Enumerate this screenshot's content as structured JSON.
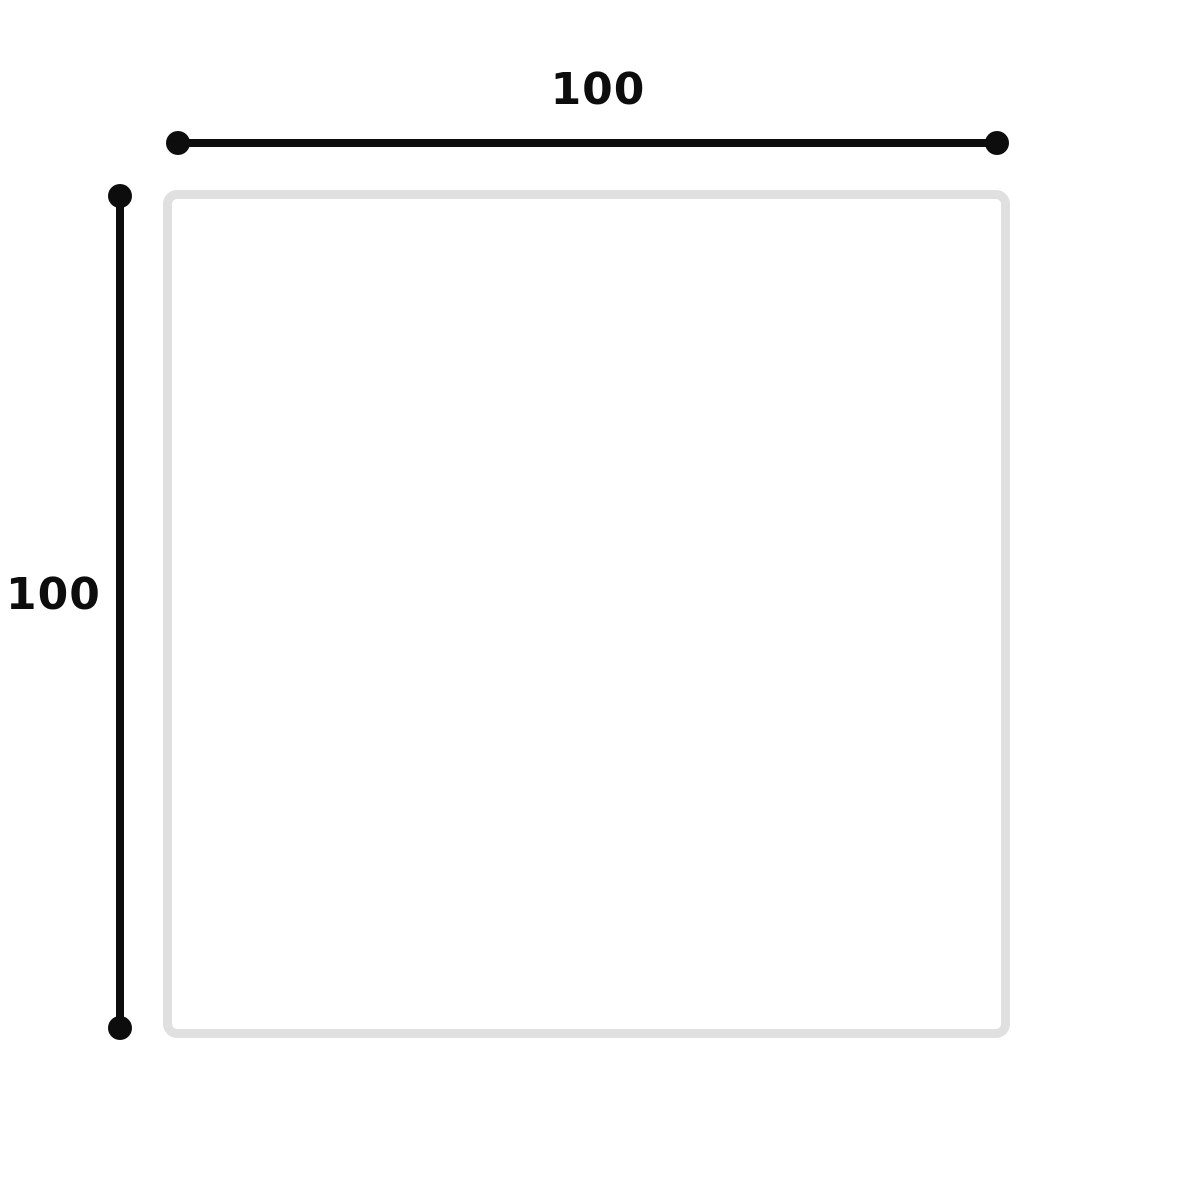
{
  "diagram": {
    "name": "dimensioned-square",
    "shape": {
      "type": "square",
      "fill": "#ffffff",
      "border_color": "#e0e0e0"
    },
    "dimensions": {
      "width": {
        "label": "100"
      },
      "height": {
        "label": "100"
      }
    },
    "colors": {
      "dimension_line": "#0d0d0d",
      "label_text": "#0d0d0d",
      "shape_border": "#e0e0e0",
      "background": "#ffffff"
    }
  }
}
